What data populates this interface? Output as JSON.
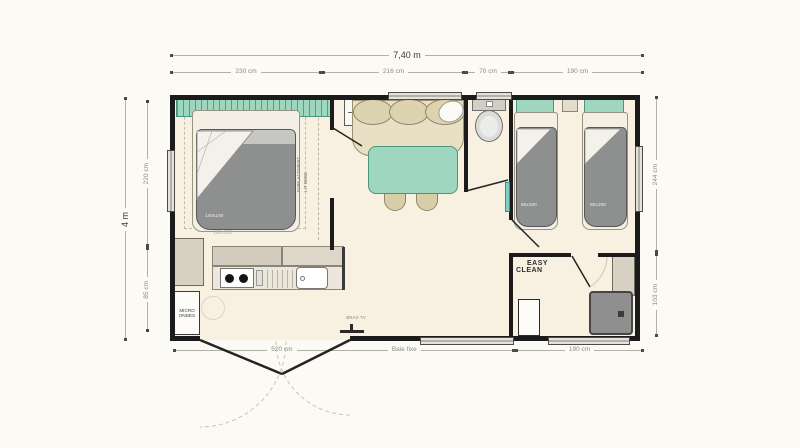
{
  "plan": {
    "total_width_label": "7,40 m",
    "total_height_label": "4 m",
    "top_segments": [
      "230 cm",
      "216 cm",
      "70 cm",
      "190 cm"
    ],
    "left_segments": [
      "220 cm",
      "85 cm"
    ],
    "right_segments": [
      "244 cm",
      "103 cm"
    ],
    "bottom_segments": [
      "520 cm",
      "Baie fixe",
      "190 cm"
    ]
  },
  "labels": {
    "baby_cot_line1": "EMPLACEMENT",
    "baby_cot_line2": "LIT BEBE",
    "microwave_line1": "MICRO",
    "microwave_line2": "ONDES",
    "tv_bracket": "BRAS TV",
    "easy_clean_line1": "EASY",
    "easy_clean_line2": "CLEAN",
    "master_bed_size": "140x190",
    "master_bed_option_size": "160x200",
    "twin_bed1_size": "80x190",
    "twin_bed2_size": "80x190"
  },
  "colors": {
    "wall": "#1b1b1b",
    "floor": "#f8f1e2",
    "teal_furniture": "#9fd6c0",
    "bed_grey": "#8e8f8f",
    "bench_beige": "#e9dfc4",
    "dimension_grey": "#8a8a8a"
  }
}
